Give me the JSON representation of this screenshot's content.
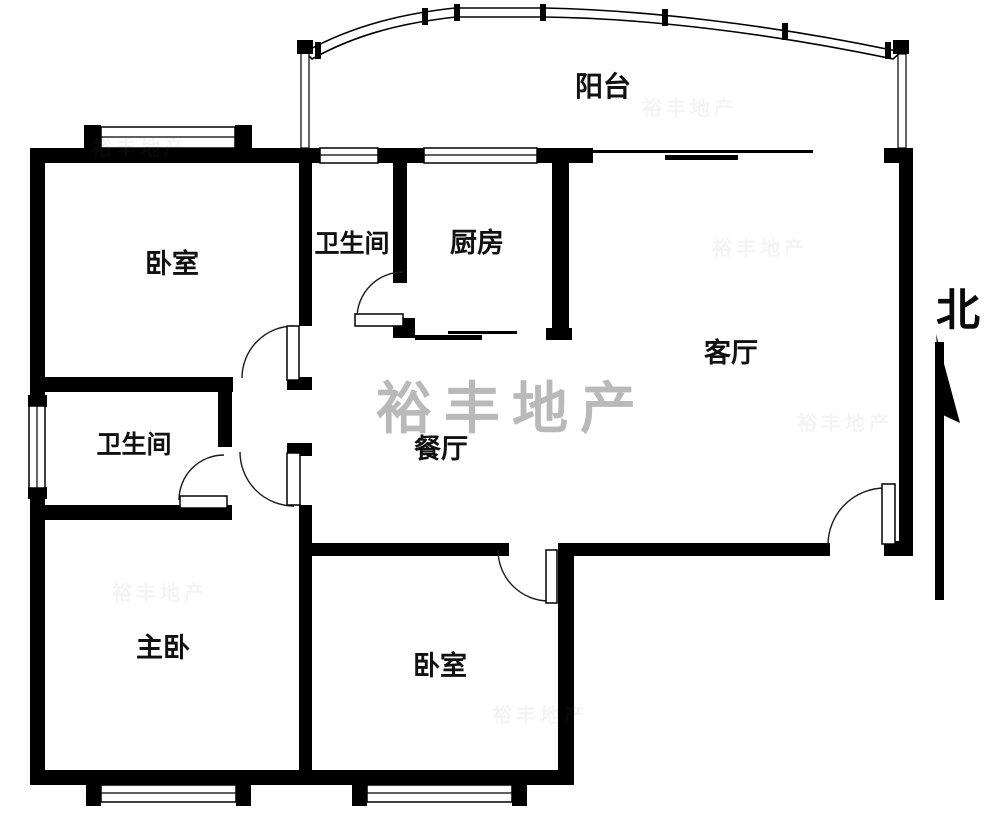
{
  "floorplan": {
    "colors": {
      "wall": "#000000",
      "background": "#ffffff",
      "watermark": "#a8a8a8"
    },
    "watermark": {
      "text": "裕丰地产"
    },
    "compass": {
      "label": "北"
    },
    "rooms": [
      {
        "id": "balcony",
        "label": "阳台"
      },
      {
        "id": "bedroom-top-left",
        "label": "卧室"
      },
      {
        "id": "bathroom-top",
        "label": "卫生间"
      },
      {
        "id": "kitchen",
        "label": "厨房"
      },
      {
        "id": "living-room",
        "label": "客厅"
      },
      {
        "id": "bathroom-left",
        "label": "卫生间"
      },
      {
        "id": "dining-room",
        "label": "餐厅"
      },
      {
        "id": "master-bedroom",
        "label": "主卧"
      },
      {
        "id": "bedroom-bottom",
        "label": "卧室"
      }
    ]
  }
}
